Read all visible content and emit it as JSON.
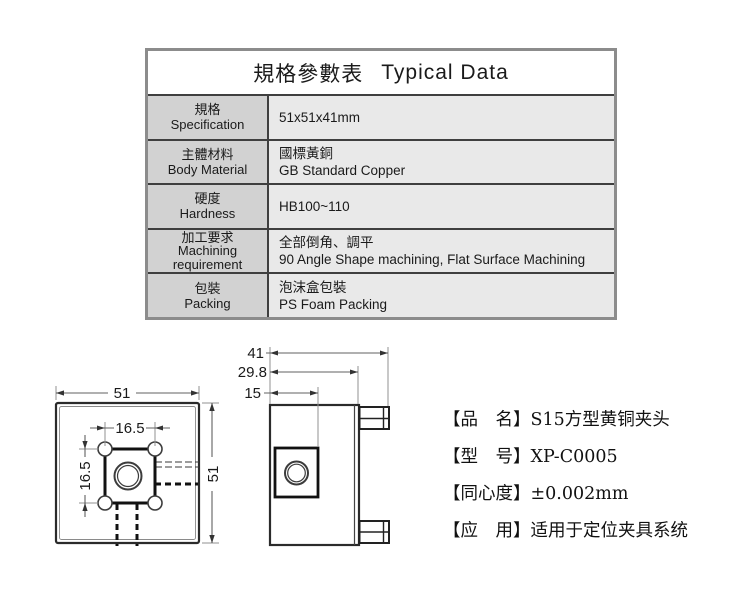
{
  "colors": {
    "table_outer_border": "#8c8c8c",
    "table_inner_border": "#3f3f3f",
    "label_cell_bg": "#d2d2d2",
    "value_cell_bg": "#e9e9e9",
    "part_line": "#2b2b2b",
    "dim_line": "#606060"
  },
  "table": {
    "title_zh": "規格參數表",
    "title_en": "Typical Data",
    "rows": [
      {
        "label_zh": "規格",
        "label_en": "Specification",
        "value_line1": "51x51x41mm"
      },
      {
        "label_zh": "主體材料",
        "label_en": "Body Material",
        "value_line1": "國標黃銅",
        "value_line2": "GB Standard Copper"
      },
      {
        "label_zh": "硬度",
        "label_en": "Hardness",
        "value_line1": "HB100~110"
      },
      {
        "label_zh": "加工要求",
        "label_en": "Machining requirement",
        "value_line1": "全部倒角、調平",
        "value_line2": "90 Angle Shape machining, Flat Surface Machining"
      },
      {
        "label_zh": "包裝",
        "label_en": "Packing",
        "value_line1": "泡沫盒包裝",
        "value_line2": "PS Foam Packing"
      }
    ]
  },
  "drawing": {
    "front_view": {
      "width_label": "51",
      "height_label": "51",
      "pocket_width_label": "16.5",
      "pocket_height_label": "16.5"
    },
    "side_view": {
      "total_width_label": "41",
      "body_width_label": "29.8",
      "hole_offset_label": "15"
    }
  },
  "product": {
    "items": [
      {
        "label": "【品　名】",
        "value": "S15方型黄铜夹头"
      },
      {
        "label": "【型　号】",
        "value": "XP-C0005"
      },
      {
        "label": "【同心度】",
        "value": "±0.002mm"
      },
      {
        "label": "【应　用】",
        "value": "适用于定位夹具系统"
      }
    ]
  }
}
